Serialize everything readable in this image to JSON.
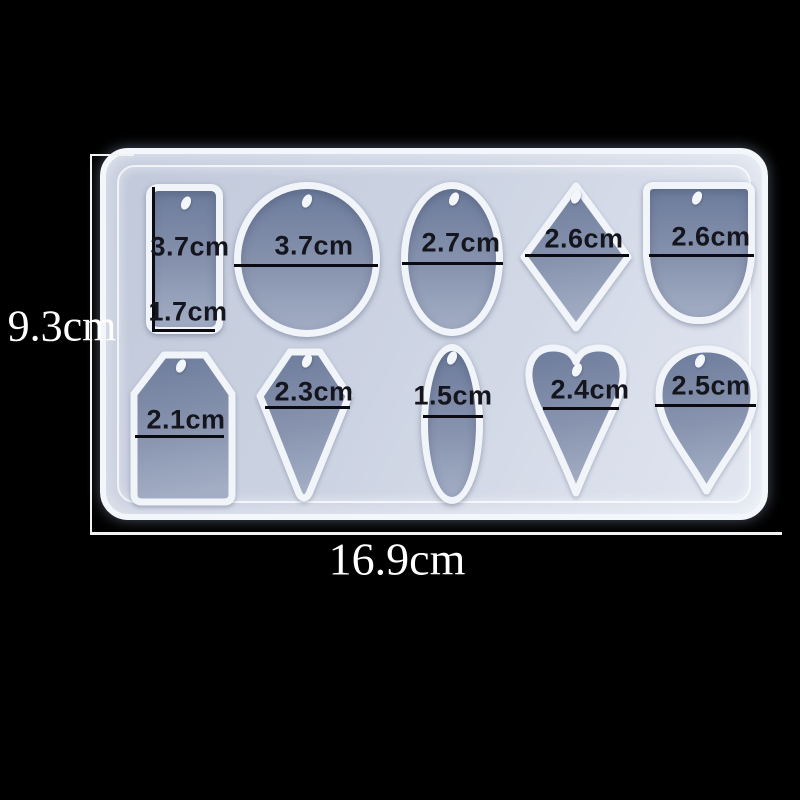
{
  "mold": {
    "outer_height_label": "9.3cm",
    "outer_width_label": "16.9cm",
    "cavities": [
      {
        "shape": "rectangle",
        "size_height": "3.7cm",
        "size_width": "1.7cm"
      },
      {
        "shape": "circle",
        "size": "3.7cm"
      },
      {
        "shape": "oval",
        "size": "2.7cm"
      },
      {
        "shape": "rhombus",
        "size": "2.6cm"
      },
      {
        "shape": "arch",
        "size": "2.6cm"
      },
      {
        "shape": "tag",
        "size": "2.1cm"
      },
      {
        "shape": "kite",
        "size": "2.3cm"
      },
      {
        "shape": "slim-oval",
        "size": "1.5cm"
      },
      {
        "shape": "heart",
        "size": "2.4cm"
      },
      {
        "shape": "teardrop",
        "size": "2.5cm"
      }
    ]
  },
  "colors": {
    "background": "#000000",
    "mold_body": "#ccd3e2",
    "mold_rim": "#f3f7fc",
    "cavity_fill_dark": "#6d7c9c",
    "cavity_fill_light": "#a3aec5",
    "measure_line": "#0a0a10",
    "cavity_label_text": "#15151e",
    "outer_label_text": "#ffffff"
  }
}
